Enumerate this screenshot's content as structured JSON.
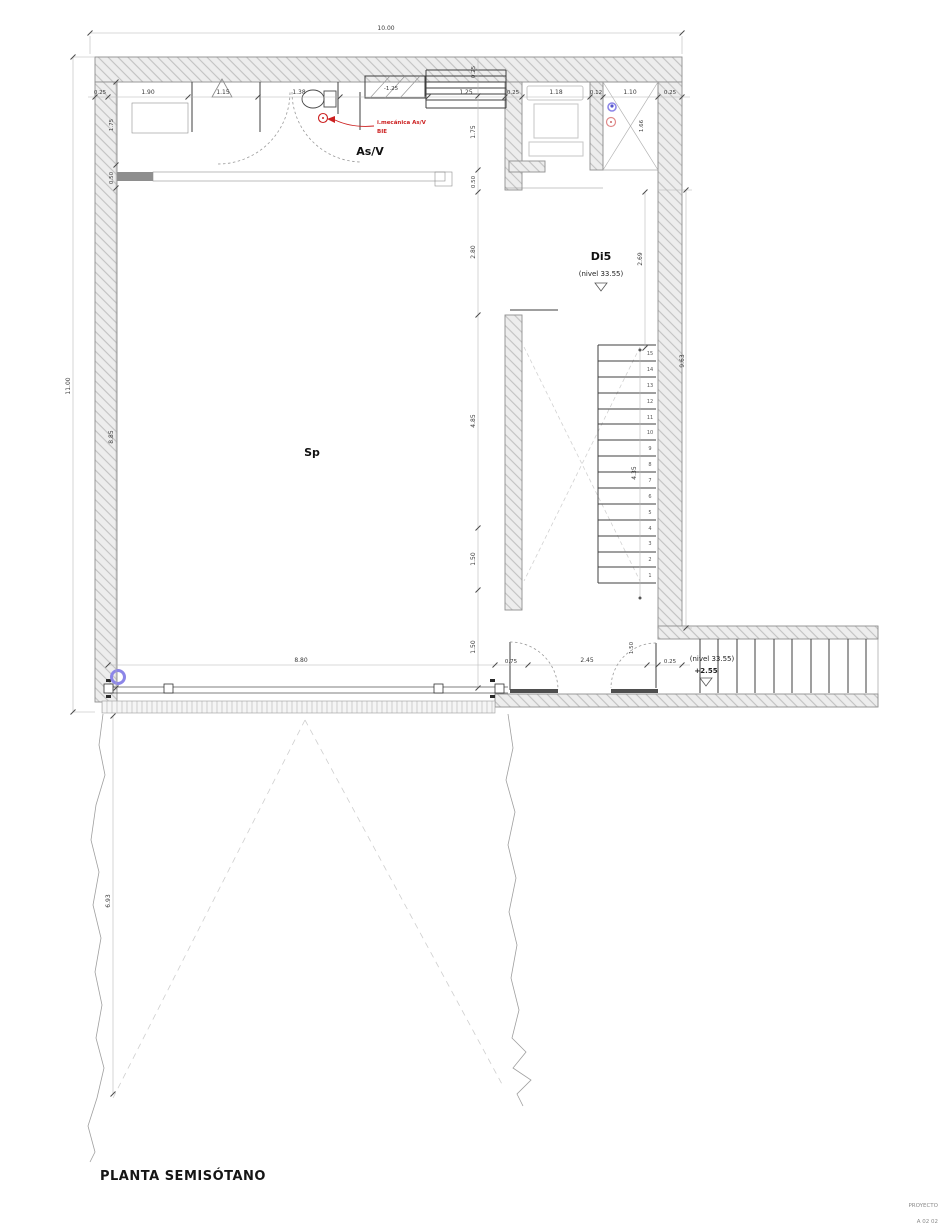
{
  "title": "PLANTA SEMISÓTANO",
  "footer": {
    "line1": "PROYECTO",
    "line2": "A 02 02"
  },
  "labels": {
    "asv": "As/V",
    "sp": "Sp",
    "di5": "Di5",
    "di5_level": "(nivel 33.55)",
    "entry_level": "(nivel 33.55)",
    "entry_value": "+2.55",
    "storage_level": "-1.25"
  },
  "red_note": {
    "line1": "i.mecánica As/V",
    "line2": "BIE"
  },
  "dims": {
    "top_total": "10.00",
    "left_total": "11.00",
    "left_chain": [
      "1.75",
      "0.50",
      "8.85"
    ],
    "top_row": [
      "0.25",
      "1.90",
      "1.15",
      "1.38",
      "1.25",
      "0.25",
      "1.18",
      "0.12",
      "1.10",
      "0.25"
    ],
    "center_chain": [
      "0.25",
      "1.75",
      "0.50",
      "2.80",
      "4.85",
      "1.50",
      "1.50"
    ],
    "right_chain": [
      "1.66",
      "2.69",
      "9.63",
      "4.35"
    ],
    "bottom_row": [
      "8.80",
      "0.75",
      "2.45",
      "0.25"
    ],
    "door_jamb": "1.50",
    "ground_depth": "6.93"
  },
  "stairs": {
    "steps": [
      "1",
      "2",
      "3",
      "4",
      "5",
      "6",
      "7",
      "8",
      "9",
      "10",
      "11",
      "12",
      "13",
      "14",
      "15"
    ]
  },
  "colors": {
    "red_annotation": "#cc2020",
    "blue_symbol": "#8c86e8",
    "pink_symbol": "#e08a8a"
  }
}
